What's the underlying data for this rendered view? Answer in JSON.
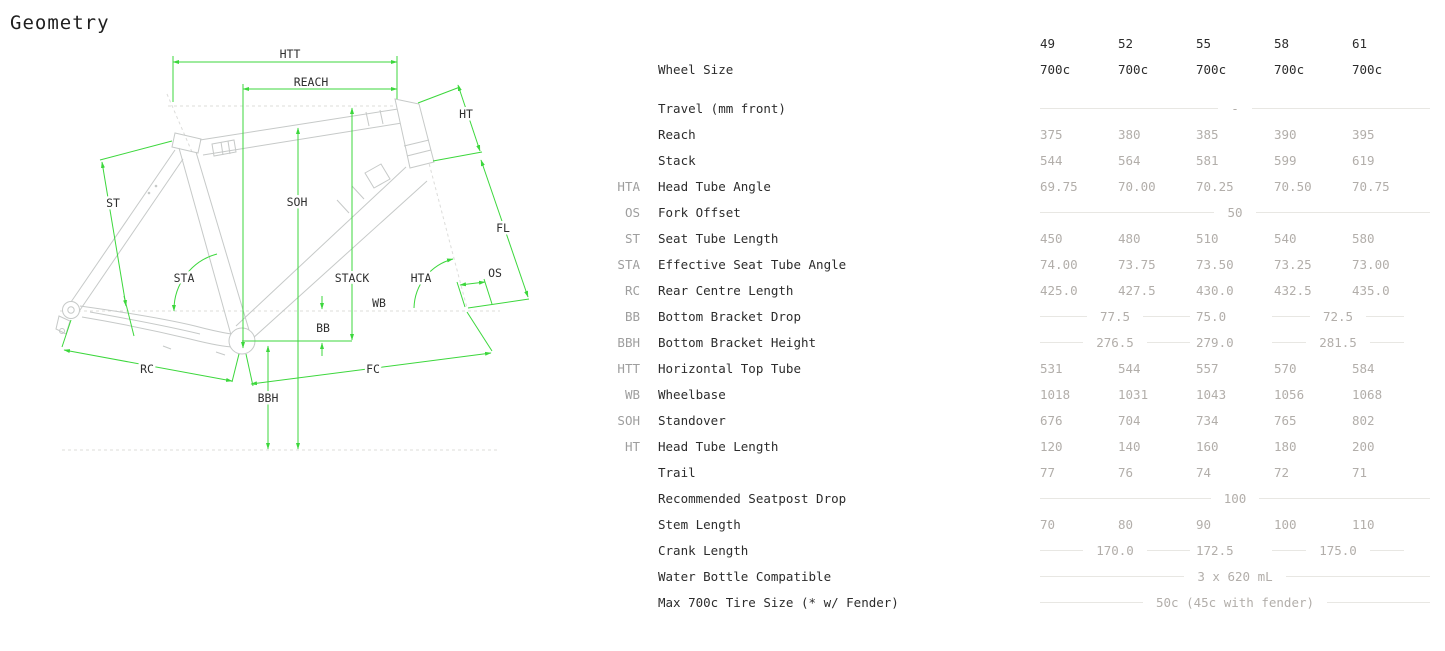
{
  "page": {
    "title": "Geometry"
  },
  "colors": {
    "dimension_green": "#3cd73c",
    "frame_gray": "#c6c9c8",
    "value_gray": "#b2aeaa",
    "label_ink": "#2c2c2c",
    "rule_gray": "#e8e7e3"
  },
  "diagram": {
    "labels": {
      "htt": "HTT",
      "reach": "REACH",
      "ht": "HT",
      "st": "ST",
      "soh": "SOH",
      "fl": "FL",
      "sta": "STA",
      "stack": "STACK",
      "hta": "HTA",
      "os": "OS",
      "wb": "WB",
      "bb": "BB",
      "rc": "RC",
      "bbh": "BBH",
      "fc": "FC"
    }
  },
  "table": {
    "size_columns": [
      "49",
      "52",
      "55",
      "58",
      "61"
    ],
    "wheel_size_row": {
      "label": "Wheel Size",
      "values": [
        "700c",
        "700c",
        "700c",
        "700c",
        "700c"
      ]
    },
    "rows": [
      {
        "code": "",
        "label": "Travel (mm front)",
        "type": "full",
        "value": "-"
      },
      {
        "code": "",
        "label": "Reach",
        "type": "cells",
        "values": [
          "375",
          "380",
          "385",
          "390",
          "395"
        ]
      },
      {
        "code": "",
        "label": "Stack",
        "type": "cells",
        "values": [
          "544",
          "564",
          "581",
          "599",
          "619"
        ]
      },
      {
        "code": "HTA",
        "label": "Head Tube Angle",
        "type": "cells",
        "values": [
          "69.75",
          "70.00",
          "70.25",
          "70.50",
          "70.75"
        ]
      },
      {
        "code": "OS",
        "label": "Fork Offset",
        "type": "full",
        "value": "50"
      },
      {
        "code": "ST",
        "label": "Seat Tube Length",
        "type": "cells",
        "values": [
          "450",
          "480",
          "510",
          "540",
          "580"
        ]
      },
      {
        "code": "STA",
        "label": "Effective Seat Tube Angle",
        "type": "cells",
        "values": [
          "74.00",
          "73.75",
          "73.50",
          "73.25",
          "73.00"
        ]
      },
      {
        "code": "RC",
        "label": "Rear Centre Length",
        "type": "cells",
        "values": [
          "425.0",
          "427.5",
          "430.0",
          "432.5",
          "435.0"
        ]
      },
      {
        "code": "BB",
        "label": "Bottom Bracket Drop",
        "type": "split",
        "values": [
          "77.5",
          "75.0",
          "72.5"
        ]
      },
      {
        "code": "BBH",
        "label": "Bottom Bracket Height",
        "type": "split",
        "values": [
          "276.5",
          "279.0",
          "281.5"
        ]
      },
      {
        "code": "HTT",
        "label": "Horizontal Top Tube",
        "type": "cells",
        "values": [
          "531",
          "544",
          "557",
          "570",
          "584"
        ]
      },
      {
        "code": "WB",
        "label": "Wheelbase",
        "type": "cells",
        "values": [
          "1018",
          "1031",
          "1043",
          "1056",
          "1068"
        ]
      },
      {
        "code": "SOH",
        "label": "Standover",
        "type": "cells",
        "values": [
          "676",
          "704",
          "734",
          "765",
          "802"
        ]
      },
      {
        "code": "HT",
        "label": "Head Tube Length",
        "type": "cells",
        "values": [
          "120",
          "140",
          "160",
          "180",
          "200"
        ]
      },
      {
        "code": "",
        "label": "Trail",
        "type": "cells",
        "values": [
          "77",
          "76",
          "74",
          "72",
          "71"
        ]
      },
      {
        "code": "",
        "label": "Recommended Seatpost Drop",
        "type": "full",
        "value": "100"
      },
      {
        "code": "",
        "label": "Stem Length",
        "type": "cells",
        "values": [
          "70",
          "80",
          "90",
          "100",
          "110"
        ]
      },
      {
        "code": "",
        "label": "Crank Length",
        "type": "split",
        "values": [
          "170.0",
          "172.5",
          "175.0"
        ]
      },
      {
        "code": "",
        "label": "Water Bottle Compatible",
        "type": "full",
        "value": "3 x 620 mL"
      },
      {
        "code": "",
        "label": "Max 700c Tire Size (* w/ Fender)",
        "type": "full",
        "value": "50c (45c with fender)"
      }
    ]
  }
}
